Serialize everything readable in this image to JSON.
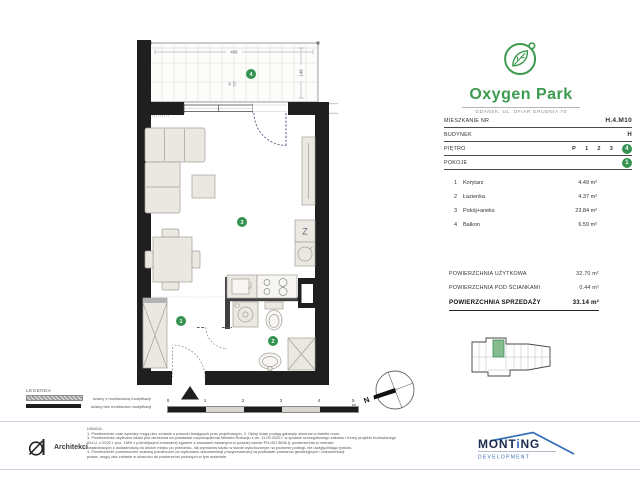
{
  "logo": {
    "brand": "Oxygen Park",
    "address": "GDAŃSK, UL. OFIAR GRUDNIA 70"
  },
  "colors": {
    "brand_green": "#3d9b50",
    "circle_green": "#359351",
    "wall_black": "#1f1f1f",
    "door_navy": "#4a4c72",
    "monting_navy": "#1c2b4e",
    "monting_blue": "#2f6db5"
  },
  "unit": {
    "rows": [
      {
        "label": "MIESZKANIE NR",
        "value": "H.4.M10"
      },
      {
        "label": "BUDYNEK",
        "value": "H"
      },
      {
        "label": "PIĘTRO"
      },
      {
        "label": "POKOJE"
      }
    ],
    "floor_options": [
      "P",
      "1",
      "2",
      "3"
    ],
    "floor_selected": "4",
    "rooms_selected": "1"
  },
  "rooms": [
    {
      "no": "1",
      "name": "Korytarz",
      "area": "4.49 m²"
    },
    {
      "no": "2",
      "name": "Łazienka",
      "area": "4.37 m²"
    },
    {
      "no": "3",
      "name": "Pokój+aneks",
      "area": "23.84 m²"
    },
    {
      "no": "4",
      "name": "Balkon",
      "area": "6.59 m²"
    }
  ],
  "summary": [
    {
      "label": "POWIERZCHNIA UŻYTKOWA",
      "value": "32.70 m²"
    },
    {
      "label": "POWIERZCHNIA POD ŚCIANKAMI",
      "value": "0.44 m²"
    },
    {
      "label": "POWIERZCHNIA SPRZEDAŻY",
      "value": "33.14 m²"
    }
  ],
  "plan": {
    "dim_top": "406",
    "dim_right": "148",
    "dim_sill_a": "30",
    "dim_sill_b": "230",
    "label_corridor": "1",
    "label_bath": "2",
    "label_room": "3",
    "label_balcony": "4",
    "fridge_glyph": "Z"
  },
  "legend": {
    "title": "LEGENDA",
    "item_modifiable": "ściany z możliwością modyfikacji",
    "item_fixed": "ściany bez możliwości modyfikacji"
  },
  "scalebar": {
    "t0": "0",
    "t1": "1",
    "t2": "2",
    "t3": "3",
    "t4": "4",
    "t5": "5 M"
  },
  "compass": {
    "north": "N"
  },
  "notes": {
    "l0": "UWAGA:",
    "l1": "1. Powierzchnie oraz wymiary mogą ulec zmianie z powodu trwających prac projektowych. 2. Opisy ścian podają gabaryty otworów w świetle muru.",
    "l2": "3. Powierzchnia użytkowa lokalu jest określona na podstawie rozporządzenia Ministra Rozwoju z dn. 11.09.2020 r. w sprawie szczegółowego zakresu i formy projektu budowlanego",
    "l3": "(Dz.U. z 2020 r. poz. 1609 z późniejszymi zmianami) zgodnie z zasadami zawartymi w polskiej normie PN-ISO 9836 tj. powierzchnia w metrach",
    "l4": "kwadratowych z dokładnością do dwóch miejsc po przecinku, dla wymiarów lokalu w stanie wykończonym na poziomie podłogi, nie uwzględniając tynków.",
    "l5": "4. Powierzchnie pomieszczeń zostaną pomierzone po wykonaniu dokumentacji powykonawczej na podstawie pomiarów geodezyjnych i dokumentacji",
    "l6": "prawa, mogą ulec zmianie w stosunku do powierzchni podanych w tym materiale."
  },
  "footer": {
    "architect": "Architekci",
    "developer_a": "MONT",
    "developer_i": "i",
    "developer_b": "NG",
    "developer_sub": "DEVELOPMENT"
  }
}
